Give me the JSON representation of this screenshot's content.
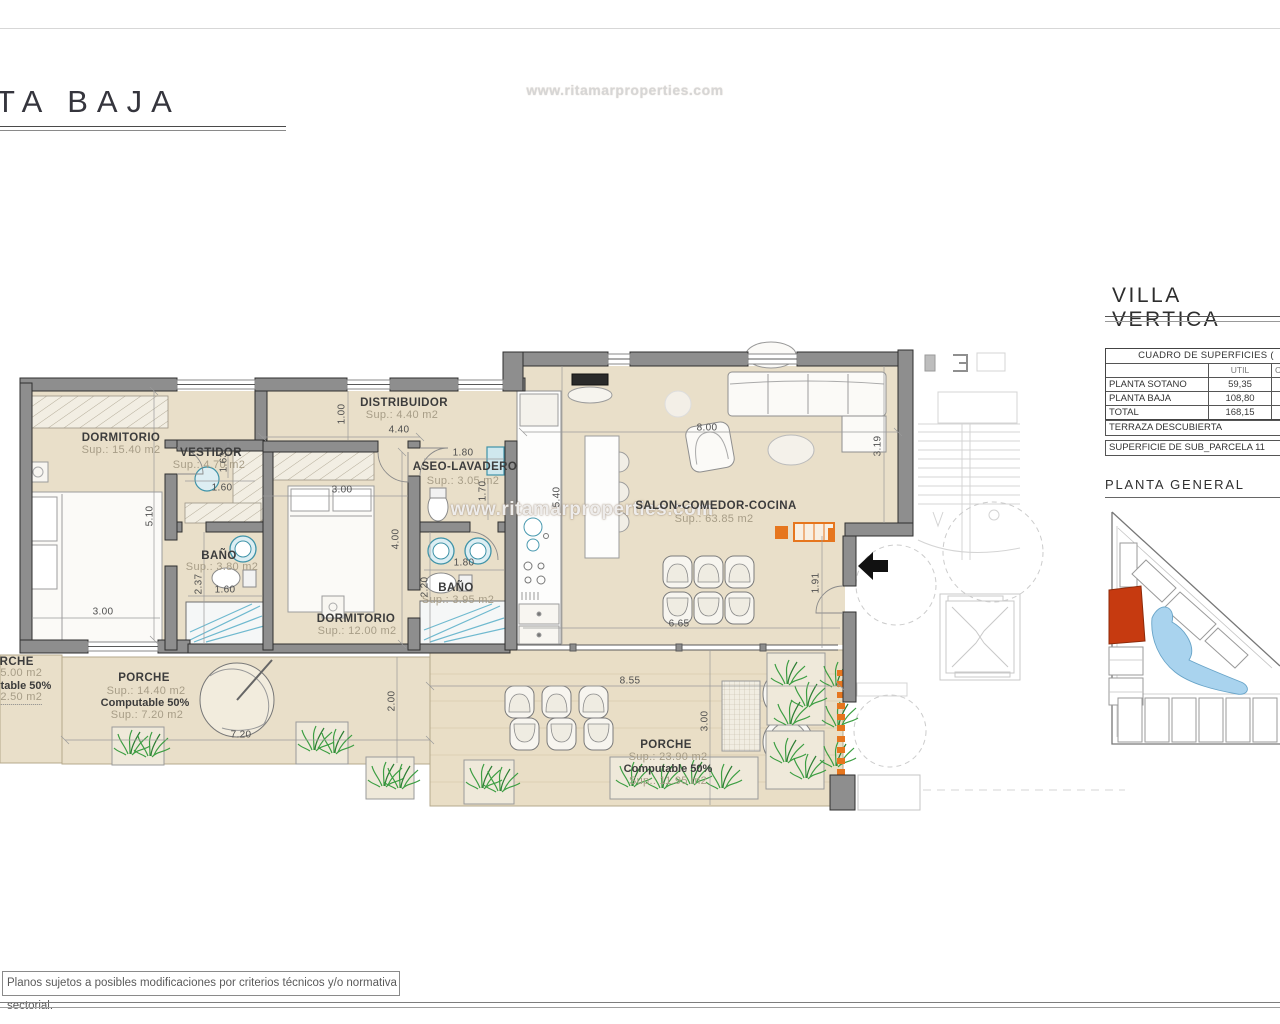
{
  "sheet": {
    "title": "TA BAJA",
    "top_watermark": "www.ritamarproperties.com",
    "plan_watermark": "www.ritamarproperties.com",
    "footer_note": "Planos sujetos a posibles modificaciones por criterios técnicos y/o normativa sectorial."
  },
  "side_panel": {
    "project_title": "VILLA VERTICA",
    "table": {
      "title": "CUADRO DE SUPERFICIES (",
      "col_util": "UTIL",
      "col_right_partial": "C",
      "rows": [
        {
          "name": "PLANTA SOTANO",
          "util": "59,35"
        },
        {
          "name": "PLANTA BAJA",
          "util": "108,80"
        },
        {
          "name": "TOTAL",
          "util": "168,15"
        }
      ]
    },
    "terraza": "TERRAZA DESCUBIERTA",
    "parcela": "SUPERFICIE DE SUB_PARCELA 11",
    "site_plan_title": "PLANTA GENERAL"
  },
  "rooms": {
    "dormitorio1": {
      "name": "DORMITORIO",
      "sup": "Sup.: 15.40  m2"
    },
    "vestidor": {
      "name": "VESTIDOR",
      "sup": "Sup.: 4.70  m2"
    },
    "distribuidor": {
      "name": "DISTRIBUIDOR",
      "sup": "Sup.: 4.40   m2"
    },
    "aseo": {
      "name": "ASEO-LAVADERO",
      "sup": "Sup.: 3.05  m2"
    },
    "salon": {
      "name": "SALON-COMEDOR-COCINA",
      "sup": "Sup.: 63.85  m2"
    },
    "banio1": {
      "name": "BAÑO",
      "sup": "Sup.: 3.80   m2"
    },
    "banio2": {
      "name": "BAÑO",
      "sup": "Sup.: 3.95   m2"
    },
    "dormitorio2": {
      "name": "DORMITORIO",
      "sup": "Sup.: 12.00  m2"
    },
    "porche_left": {
      "name": "PORCHE",
      "sup": "Sup.: 5.00   m2",
      "computable": "Computable 50%",
      "sup2": "Sup.: 2.50   m2"
    },
    "porche_center": {
      "name": "PORCHE",
      "sup": "Sup.: 14.40  m2",
      "computable": "Computable 50%",
      "sup2": "Sup.: 7.20   m2"
    },
    "porche_bottom": {
      "name": "PORCHE",
      "sup": "Sup.: 23.90  m2",
      "computable": "Computable 50%",
      "sup2": "Sup.: 11.95  m2"
    }
  },
  "dims": {
    "dorm1_h": "5.10",
    "dorm1_w": "3.00",
    "vestidor_h": "1.63",
    "vestidor_w": "1.60",
    "distrib_h": "1.00",
    "distrib_w": "4.40",
    "dorm2_w": "3.00",
    "dorm2_h": "4.00",
    "banio1_h": "2.37",
    "banio1_w": "1.60",
    "aseo_w": "1.80",
    "aseo_h": "1.70",
    "banio2_w": "1.80",
    "banio2_h": "2.20",
    "cocina_h": "5.40",
    "salon_w": "8.00",
    "salon_h": "3.19",
    "entrada_h": "1.91",
    "salon_bottom_w": "6.65",
    "porche_bottom_w": "8.55",
    "porche_bottom_h": "3.00",
    "porche_center_h": "2.00",
    "porche_center_w": "7.20"
  }
}
